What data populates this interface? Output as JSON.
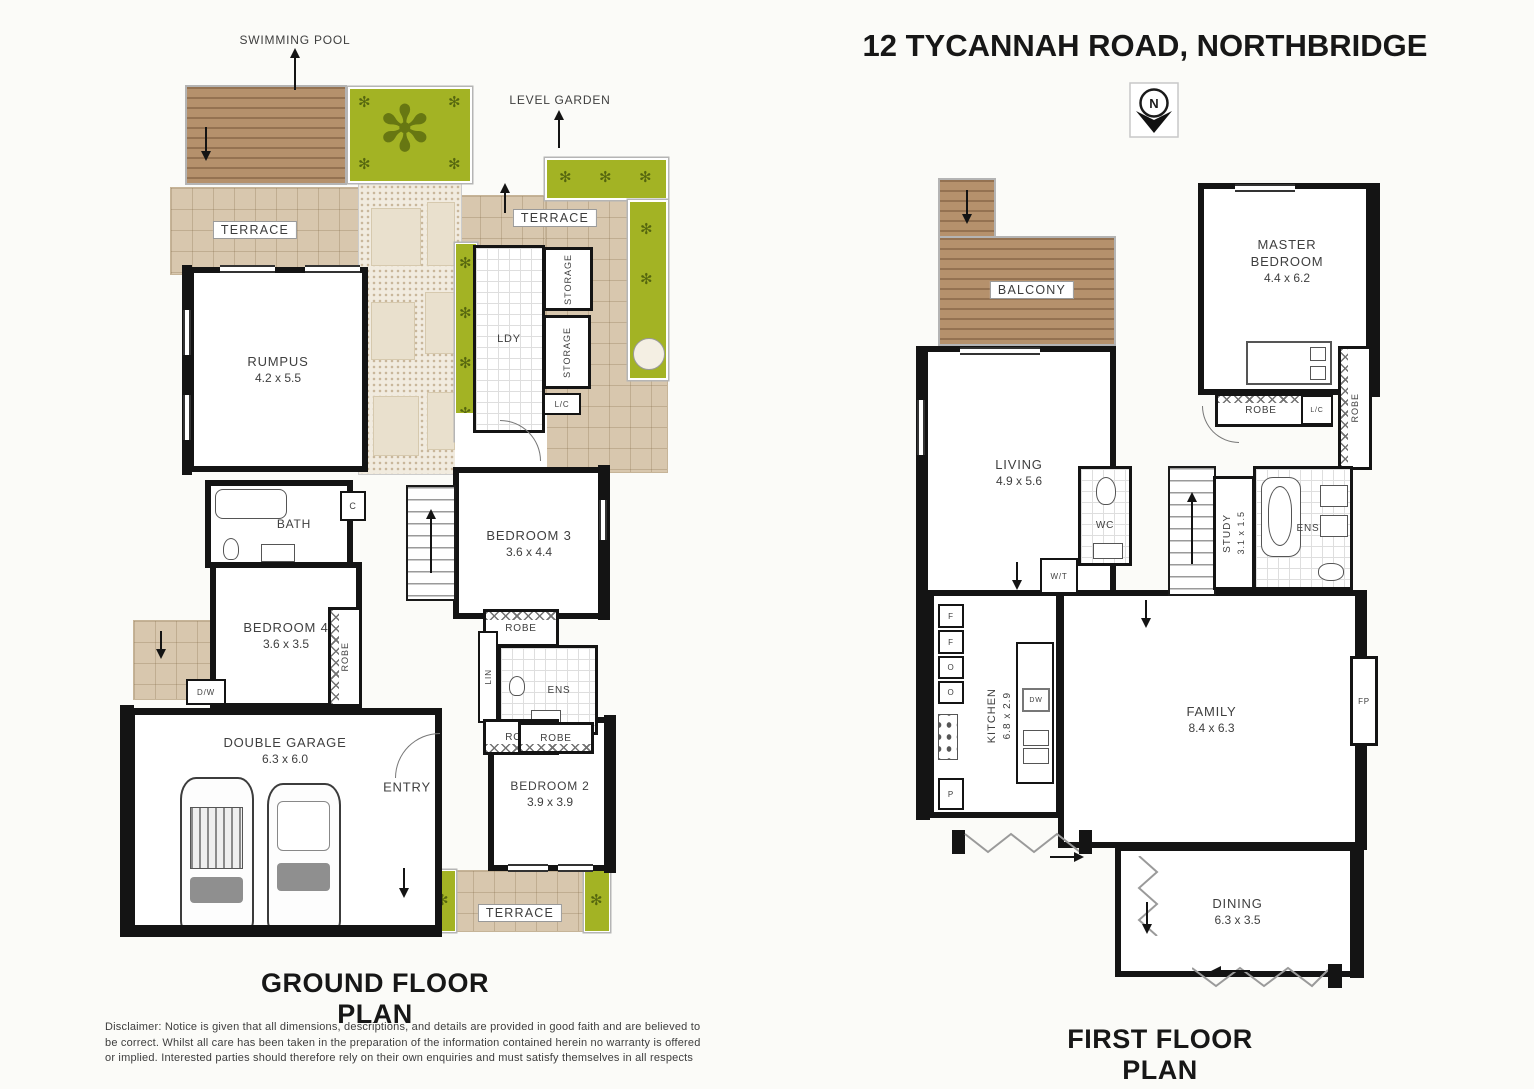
{
  "header": {
    "title": "12 TYCANNAH ROAD, NORTHBRIDGE",
    "compass_letter": "N"
  },
  "annotations": {
    "swimming_pool": "SWIMMING POOL",
    "level_garden": "LEVEL GARDEN"
  },
  "glyphs": {
    "plant": "✻"
  },
  "ground_floor": {
    "title": "GROUND FLOOR PLAN",
    "terrace_left": "TERRACE",
    "terrace_right": "TERRACE",
    "terrace_bottom": "TERRACE",
    "rumpus": {
      "name": "RUMPUS",
      "dims": "4.2 x 5.5"
    },
    "laundry": "LDY",
    "storage_top": "STORAGE",
    "storage_bottom": "STORAGE",
    "linen_cupboard": "L/C",
    "bath": "BATH",
    "cupboard": "C",
    "dw": "D/W",
    "bedroom3": {
      "name": "BEDROOM 3",
      "dims": "3.6 x 4.4"
    },
    "bedroom4": {
      "name": "BEDROOM 4",
      "dims": "3.6 x 3.5"
    },
    "robe_bedroom4": "ROBE",
    "robe_bedroom3": "ROBE",
    "linen": "LIN",
    "ensuite": "ENS",
    "robe_lower": "ROBE",
    "garage": {
      "name": "DOUBLE GARAGE",
      "dims": "6.3 x 6.0"
    },
    "entry": "ENTRY",
    "bedroom2": {
      "name": "BEDROOM 2",
      "dims": "3.9 x 3.9"
    },
    "robe_bedroom2": "ROBE"
  },
  "first_floor": {
    "title": "FIRST FLOOR PLAN",
    "balcony": "BALCONY",
    "living": {
      "name": "LIVING",
      "dims": "4.9 x 5.6"
    },
    "master": {
      "name_line1": "MASTER",
      "name_line2": "BEDROOM",
      "dims": "4.4 x 6.2"
    },
    "robe_master": "ROBE",
    "linen_cupboard": "L/C",
    "robe_wall": "ROBE",
    "wc": "WC",
    "wt": "W/T",
    "study": {
      "name": "STUDY",
      "dims": "3.1 x 1.5"
    },
    "ensuite": "ENS",
    "kitchen": {
      "name": "KITCHEN",
      "dims": "6.8 x 2.9"
    },
    "fridge1": "F",
    "fridge2": "F",
    "oven1": "O",
    "oven2": "O",
    "pantry": "P",
    "dishwasher": "DW",
    "fireplace": "FP",
    "family": {
      "name": "FAMILY",
      "dims": "8.4 x 6.3"
    },
    "dining": {
      "name": "DINING",
      "dims": "6.3 x 3.5"
    }
  },
  "disclaimer": "Disclaimer: Notice is given that all dimensions, descriptions, and details are provided in good faith and are believed to be correct. Whilst all care has been taken in the preparation of the information contained herein no warranty is offered or implied. Interested parties should therefore rely on their own enquiries and must satisfy themselves in all respects"
}
